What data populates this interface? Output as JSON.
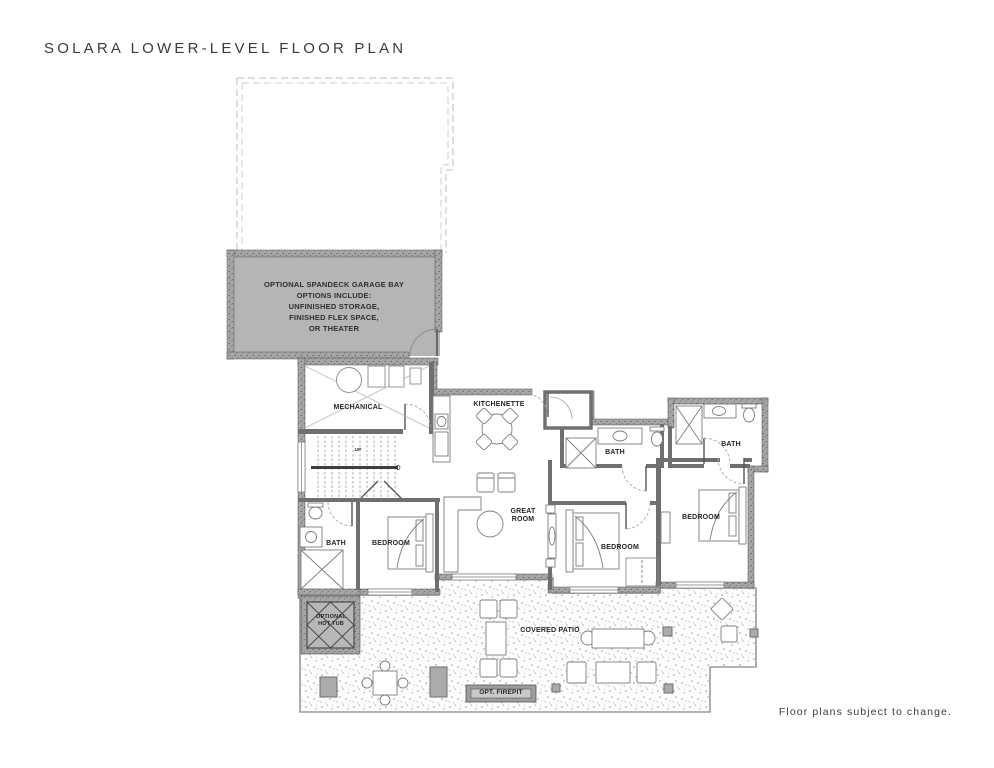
{
  "page": {
    "title": "SOLARA LOWER-LEVEL FLOOR PLAN",
    "footer_note": "Floor plans subject to change."
  },
  "garage_bay": {
    "lines": [
      "OPTIONAL SPANDECK GARAGE BAY",
      "OPTIONS INCLUDE:",
      "UNFINISHED STORAGE,",
      "FINISHED FLEX SPACE,",
      "OR THEATER"
    ]
  },
  "rooms": {
    "mechanical": "MECHANICAL",
    "kitchenette": "KITCHENETTE",
    "great_room": "GREAT ROOM",
    "bedroom_left": "BEDROOM",
    "bedroom_middle": "BEDROOM",
    "bedroom_right": "BEDROOM",
    "bath_left": "BATH",
    "bath_middle": "BATH",
    "bath_right": "BATH",
    "stairs": "UP",
    "hot_tub": "OPTIONAL HOT TUB",
    "covered_patio": "COVERED PATIO",
    "firepit": "OPT. FIREPIT"
  },
  "colors": {
    "garage_fill": "#b5b5b5",
    "exterior_wall": "#a3a3a3",
    "interior_wall": "#6f6f6f",
    "text": "#2e2e2e"
  }
}
